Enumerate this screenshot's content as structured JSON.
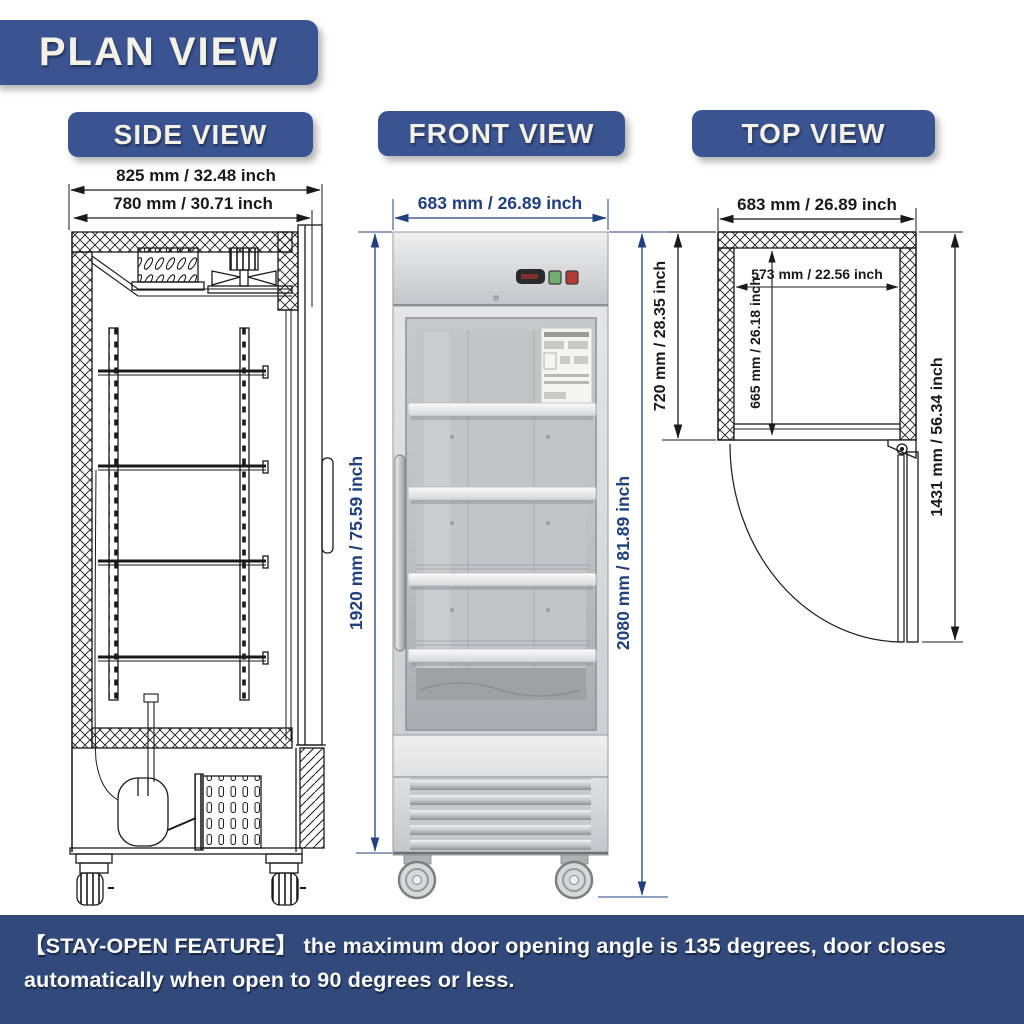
{
  "header": {
    "title": "PLAN VIEW"
  },
  "views": {
    "side": {
      "label": "SIDE VIEW",
      "dims": {
        "overall_depth": "825 mm / 32.48 inch",
        "cabinet_depth": "780 mm / 30.71 inch"
      }
    },
    "front": {
      "label": "FRONT VIEW",
      "dims": {
        "width": "683 mm / 26.89 inch",
        "cabinet_height": "1920 mm / 75.59 inch",
        "overall_height": "2080 mm / 81.89 inch"
      }
    },
    "top": {
      "label": "TOP VIEW",
      "dims": {
        "width": "683 mm / 26.89 inch",
        "depth": "720 mm / 28.35 inch",
        "interior_width": "573 mm / 22.56 inch",
        "interior_depth": "665 mm / 26.18 inch",
        "door_open_clearance": "1431 mm / 56.34 inch"
      }
    }
  },
  "footer": {
    "note": "【STAY-OPEN FEATURE】 the maximum door opening angle is 135 degrees, door closes automatically when open to 90 degrees or less."
  },
  "colors": {
    "banner_blue": "#3a5391",
    "footer_blue": "#31497b",
    "dimension_blue": "#21407f",
    "drawing_line": "#1a1a1a",
    "label_text": "#f4f1e6",
    "button_green": "#6fae6f",
    "button_red": "#b23a3a"
  }
}
